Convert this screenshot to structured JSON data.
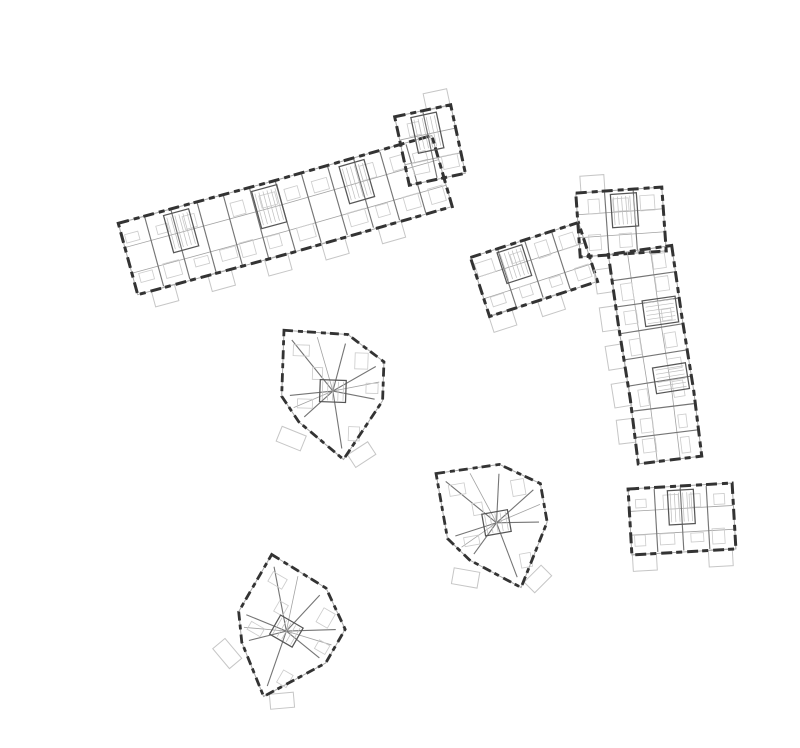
{
  "scene": {
    "width": 800,
    "height": 748,
    "background": "#ffffff",
    "title": ""
  },
  "palette": {
    "wall": "#333333",
    "window_line": "#a8a8a8",
    "partition": "#757575",
    "partition_light": "#a2a2a2",
    "furniture": "#cdcdcd",
    "balcony": "#c6c6c6",
    "hatch": "#bdbdbd",
    "core": "#565656",
    "background": "#ffffff"
  },
  "wall_style": {
    "dash": "11 5 6 4",
    "dash_point": "9 5 5 4",
    "wall_width": 3,
    "window_width": 1
  },
  "buildings": [
    {
      "id": "north-slab",
      "kind": "slab",
      "centerline": [
        [
          128,
          259
        ],
        [
          282,
          217
        ],
        [
          442,
          171
        ]
      ],
      "width": 74,
      "rib_spacing": 27,
      "seed": 3,
      "cores": [
        0.18,
        0.46,
        0.74
      ],
      "balconies": {
        "side": 1,
        "fractions": [
          0.08,
          0.26,
          0.44,
          0.62,
          0.8
        ]
      }
    },
    {
      "id": "north-slab-end-block",
      "kind": "slab",
      "centerline": [
        [
          402,
          151
        ],
        [
          458,
          139
        ]
      ],
      "width": 70,
      "rib_spacing": 26,
      "seed": 5,
      "cores": [
        0.5
      ],
      "balconies": {
        "side": -1,
        "fractions": [
          0.78
        ]
      }
    },
    {
      "id": "east-l-arm",
      "kind": "slab",
      "centerline": [
        [
          480,
          287
        ],
        [
          588,
          252
        ]
      ],
      "width": 62,
      "rib_spacing": 27,
      "seed": 7,
      "cores": [
        0.35
      ],
      "balconies": {
        "side": 1,
        "fractions": [
          0.1,
          0.55
        ]
      }
    },
    {
      "id": "east-l-corner",
      "kind": "slab",
      "centerline": [
        [
          578,
          225
        ],
        [
          664,
          219
        ]
      ],
      "width": 64,
      "rib_spacing": 27,
      "seed": 9,
      "cores": [
        0.55
      ],
      "balconies": {
        "side": -1,
        "fractions": [
          0.2
        ]
      }
    },
    {
      "id": "east-l-spine",
      "kind": "slab",
      "centerline": [
        [
          640,
          250
        ],
        [
          650,
          320
        ],
        [
          662,
          395
        ],
        [
          670,
          460
        ]
      ],
      "width": 64,
      "rib_spacing": 26,
      "seed": 11,
      "cores": [
        0.3,
        0.62
      ],
      "balconies": {
        "side": 1,
        "fractions": [
          0.12,
          0.3,
          0.48,
          0.66,
          0.84
        ]
      }
    },
    {
      "id": "east-l-foot",
      "kind": "slab",
      "centerline": [
        [
          630,
          522
        ],
        [
          734,
          516
        ]
      ],
      "width": 66,
      "rib_spacing": 28,
      "seed": 13,
      "cores": [
        0.5
      ],
      "balconies": {
        "side": 1,
        "fractions": [
          0.12,
          0.85
        ]
      }
    },
    {
      "id": "point-house-1",
      "kind": "point",
      "position": [
        332,
        388
      ],
      "rotation": 2,
      "seed": 17
    },
    {
      "id": "point-house-2",
      "kind": "point",
      "position": [
        495,
        520
      ],
      "rotation": -10,
      "seed": 19
    },
    {
      "id": "point-house-3",
      "kind": "point",
      "position": [
        287,
        628
      ],
      "rotation": 30,
      "seed": 23
    }
  ],
  "point_type": {
    "outline": [
      [
        -50,
        -56
      ],
      [
        14,
        -54
      ],
      [
        51,
        -28
      ],
      [
        51,
        11
      ],
      [
        14,
        71
      ],
      [
        -32,
        35
      ],
      [
        -50,
        10
      ]
    ],
    "core": [
      -12,
      -8,
      26,
      22
    ],
    "radials": [
      0,
      1,
      2,
      3,
      4,
      5,
      6
    ],
    "mid_edges": [
      [
        0,
        1
      ],
      [
        2,
        3
      ],
      [
        5,
        6
      ]
    ],
    "furniture": [
      [
        -40,
        -42,
        16,
        11
      ],
      [
        22,
        -36,
        13,
        16
      ],
      [
        -34,
        12,
        15,
        9
      ],
      [
        18,
        38,
        11,
        14
      ],
      [
        34,
        -6,
        12,
        10
      ],
      [
        -20,
        -20,
        10,
        12
      ]
    ],
    "balconies": [
      [
        -52,
        44,
        26,
        16,
        20
      ],
      [
        20,
        58,
        24,
        15,
        -35
      ]
    ]
  }
}
